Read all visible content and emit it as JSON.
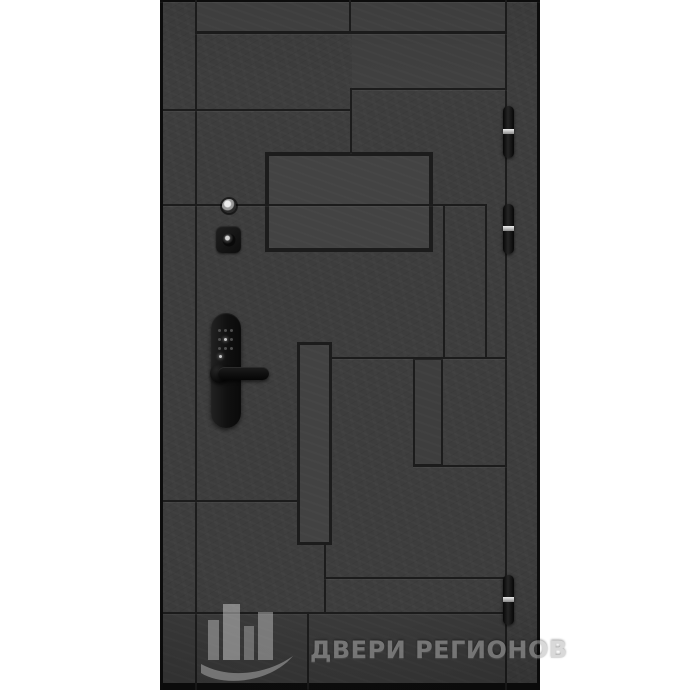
{
  "watermark": {
    "text": "ДВЕРИ РЕГИОНОВ",
    "color": "#b5b5b5"
  },
  "colors": {
    "background": "#ffffff",
    "door_base": "#3d3d3d",
    "groove": "#1c1c1c",
    "frame": "#0d0d0d",
    "panel_light": "#424242",
    "hinge_highlight": "#dedede",
    "hardware_black": "#121212",
    "watermark_gray": "#b5b5b5"
  },
  "door": {
    "x": 160,
    "y": 0,
    "width": 380,
    "height": 690
  },
  "pattern": {
    "panels": [
      {
        "x": 37,
        "y": 0,
        "w": 308,
        "h": 31,
        "fill": "#414141"
      },
      {
        "x": 192,
        "y": 33,
        "w": 153,
        "h": 56,
        "fill": "#404040"
      },
      {
        "x": 3,
        "y": 613,
        "w": 342,
        "h": 75,
        "fill": "#3a3a3a"
      },
      {
        "x": 105,
        "y": 152,
        "w": 168,
        "h": 100,
        "bw": 4,
        "fill": "#434343"
      },
      {
        "x": 137,
        "y": 342,
        "w": 35,
        "h": 203,
        "bw": 3,
        "fill": "#424242"
      },
      {
        "x": 253,
        "y": 358,
        "w": 30,
        "h": 108,
        "bw": 2,
        "fill": "#3e3e3e"
      }
    ],
    "grooves": [
      {
        "x": 0,
        "y": 0,
        "w": 3,
        "h": 690,
        "c": "frame"
      },
      {
        "x": 377,
        "y": 0,
        "w": 3,
        "h": 690,
        "c": "frame"
      },
      {
        "x": 0,
        "y": 0,
        "w": 380,
        "h": 2,
        "c": "frame"
      },
      {
        "x": 0,
        "y": 683,
        "w": 380,
        "h": 7,
        "c": "frame"
      },
      {
        "x": 35,
        "y": 0,
        "w": 2,
        "h": 690
      },
      {
        "x": 345,
        "y": 0,
        "w": 2,
        "h": 690
      },
      {
        "x": 189,
        "y": 0,
        "w": 2,
        "h": 31
      },
      {
        "x": 35,
        "y": 31,
        "w": 312,
        "h": 3
      },
      {
        "x": 190,
        "y": 88,
        "w": 157,
        "h": 2
      },
      {
        "x": 190,
        "y": 88,
        "w": 2,
        "h": 65
      },
      {
        "x": 3,
        "y": 109,
        "w": 187,
        "h": 2
      },
      {
        "x": 3,
        "y": 204,
        "w": 322,
        "h": 2
      },
      {
        "x": 325,
        "y": 204,
        "w": 2,
        "h": 154
      },
      {
        "x": 283,
        "y": 204,
        "w": 2,
        "h": 154
      },
      {
        "x": 172,
        "y": 357,
        "w": 175,
        "h": 2
      },
      {
        "x": 253,
        "y": 465,
        "w": 94,
        "h": 2
      },
      {
        "x": 3,
        "y": 500,
        "w": 134,
        "h": 2
      },
      {
        "x": 164,
        "y": 545,
        "w": 2,
        "h": 68
      },
      {
        "x": 164,
        "y": 577,
        "w": 183,
        "h": 2
      },
      {
        "x": 3,
        "y": 612,
        "w": 344,
        "h": 2
      },
      {
        "x": 147,
        "y": 613,
        "w": 2,
        "h": 76
      }
    ]
  },
  "hardware": {
    "hinges": [
      {
        "name": "door-hinge-top",
        "y": 106,
        "h": 52
      },
      {
        "name": "door-hinge-middle",
        "y": 204,
        "h": 50
      },
      {
        "name": "door-hinge-bottom",
        "y": 575,
        "h": 50
      }
    ],
    "smart_lock": {
      "keypad_dots": [
        {
          "x": 1,
          "y": 2
        },
        {
          "x": 7,
          "y": 2
        },
        {
          "x": 13,
          "y": 2
        },
        {
          "x": 1,
          "y": 11
        },
        {
          "x": 7,
          "y": 11,
          "bright": true
        },
        {
          "x": 13,
          "y": 11
        },
        {
          "x": 1,
          "y": 20
        },
        {
          "x": 7,
          "y": 20
        },
        {
          "x": 13,
          "y": 20
        },
        {
          "x": 2,
          "y": 28,
          "bright": true
        }
      ]
    }
  }
}
